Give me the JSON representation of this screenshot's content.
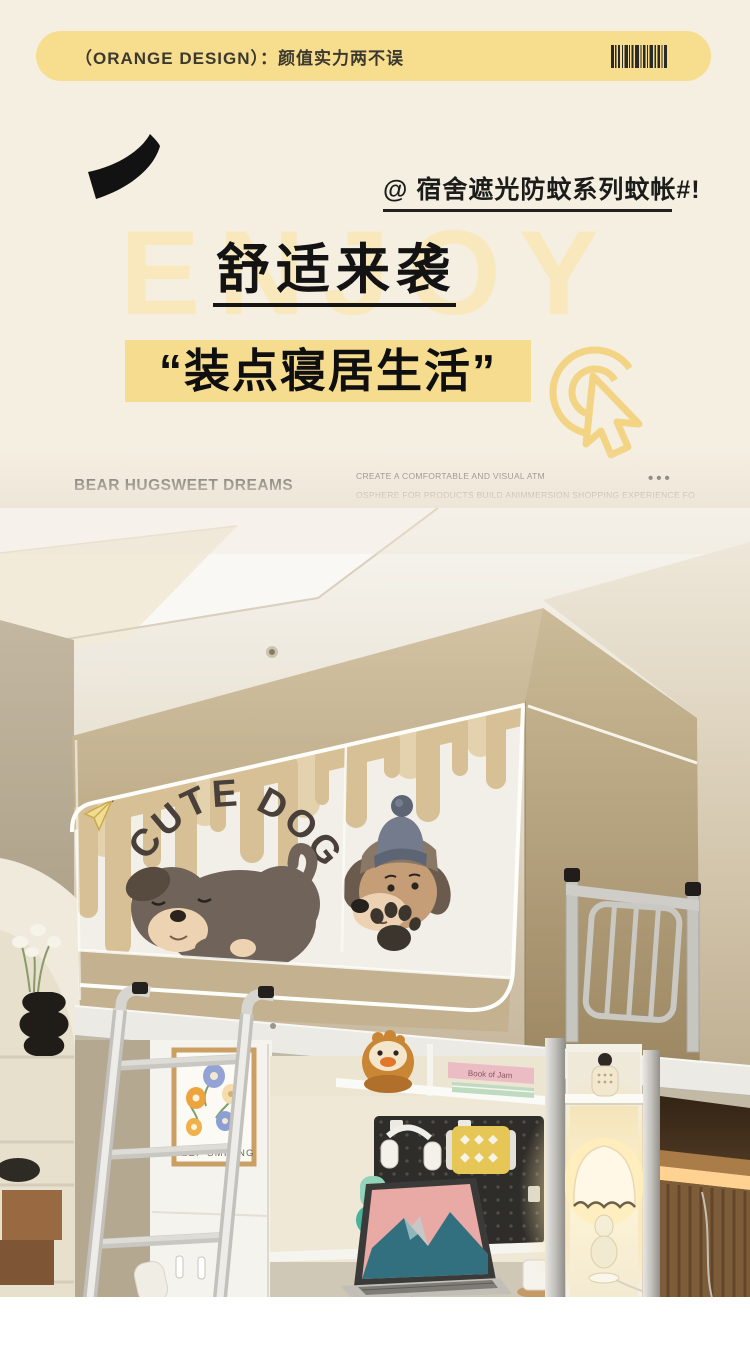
{
  "banner": {
    "label": "（ORANGE DESIGN）：颜值实力两不误",
    "bg": "#f7dd8e"
  },
  "hero": {
    "tagline": "@ 宿舍遮光防蚊系列蚊帐#!",
    "background_word": "ENJOY",
    "title": "舒适来袭",
    "highlight": "“装点寝居生活”"
  },
  "divider": {
    "left_text": "BEAR HUGSWEET DREAMS",
    "right_line1": "CREATE A COMFORTABLE AND VISUAL ATM",
    "right_line2": "OSPHERE FOR PRODUCTS BUILD ANIMMERSION SHOPPING EXPERIENCE FO",
    "dots": "•••"
  },
  "photo": {
    "net_text": "CUTE DOG",
    "poster_text": "KEEP SMILING",
    "book_text": "Book of Jam"
  },
  "colors": {
    "page_bg": "#f5efe2",
    "banner_yellow": "#f7dd8e",
    "enjoy_yellow": "#f8e8bc",
    "highlight_yellow": "#f6dc8e",
    "ink": "#131313",
    "net_khaki": "#c6b493",
    "glow_warm": "#ffe9b8"
  }
}
